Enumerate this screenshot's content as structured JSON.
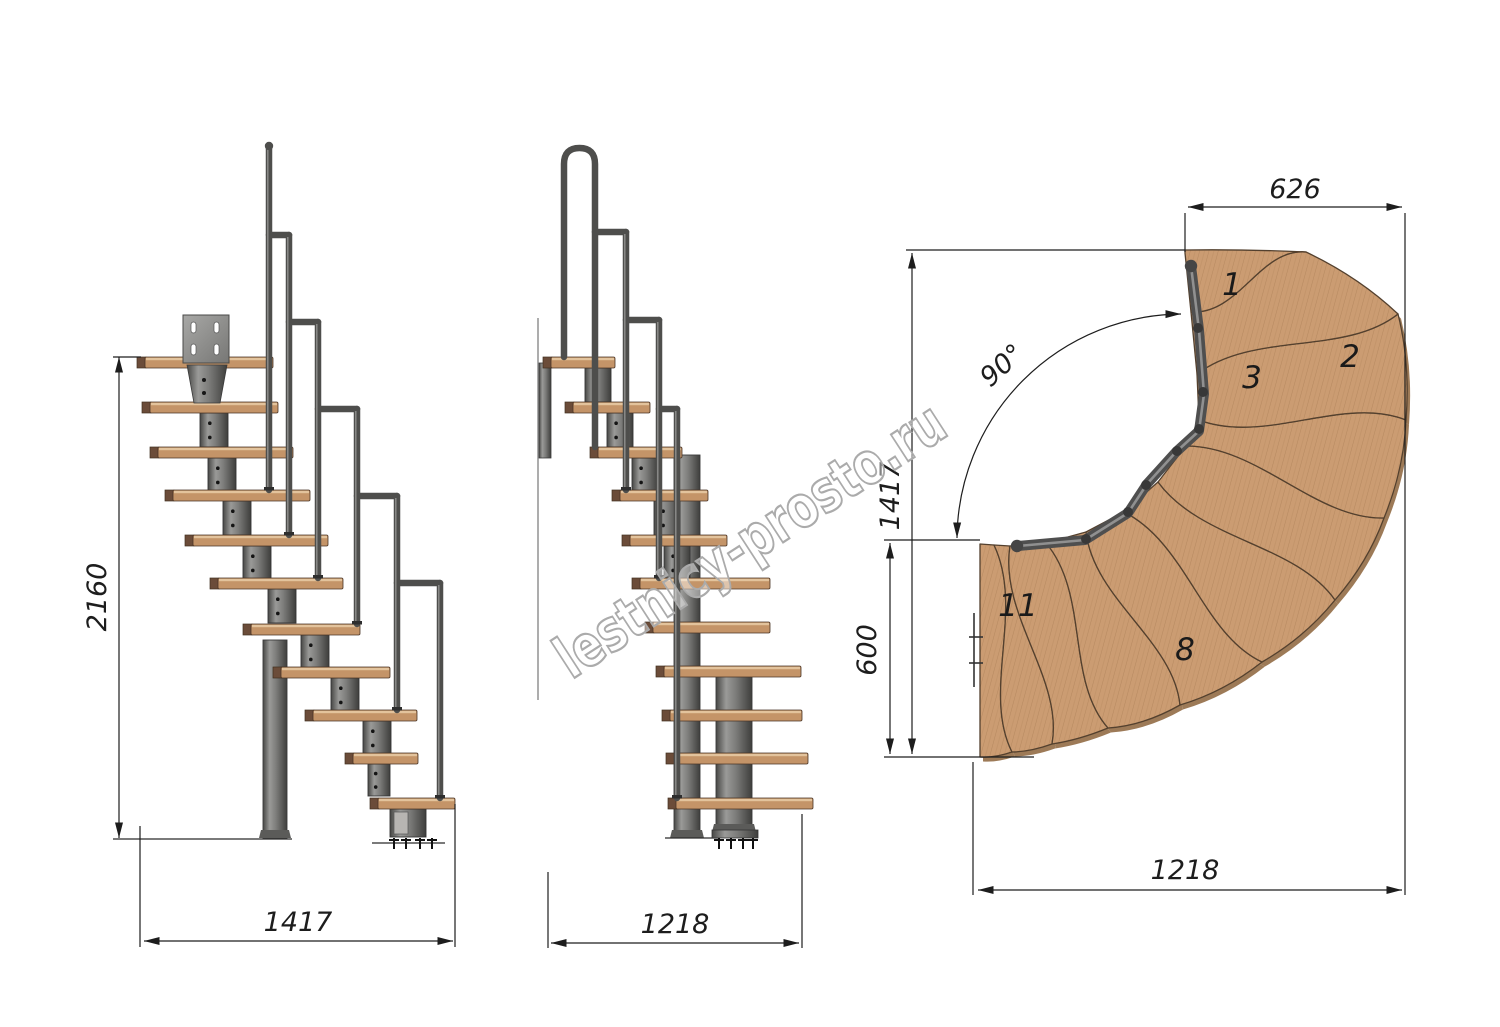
{
  "watermark": {
    "text": "lestnicy-prosto.ru"
  },
  "views": {
    "side_elevation": {
      "dims": {
        "height": "2160",
        "width": "1417"
      }
    },
    "front_elevation": {
      "dims": {
        "width": "1218"
      }
    },
    "plan": {
      "dims": {
        "top_width": "626",
        "total_depth": "1417",
        "lower_depth": "600",
        "bottom_width": "1218",
        "turn_angle": "90°"
      },
      "step_numbers": [
        {
          "label": "1"
        },
        {
          "label": "2"
        },
        {
          "label": "3"
        },
        {
          "label": "8"
        },
        {
          "label": "11"
        }
      ]
    }
  },
  "colors": {
    "wood": "#c79b6e",
    "wood_end": "#6b4c39",
    "metal": "#7a7a78",
    "rail": "#4d4d4d",
    "dimension": "#1d1d1d",
    "watermark_outline": "#ababab"
  }
}
